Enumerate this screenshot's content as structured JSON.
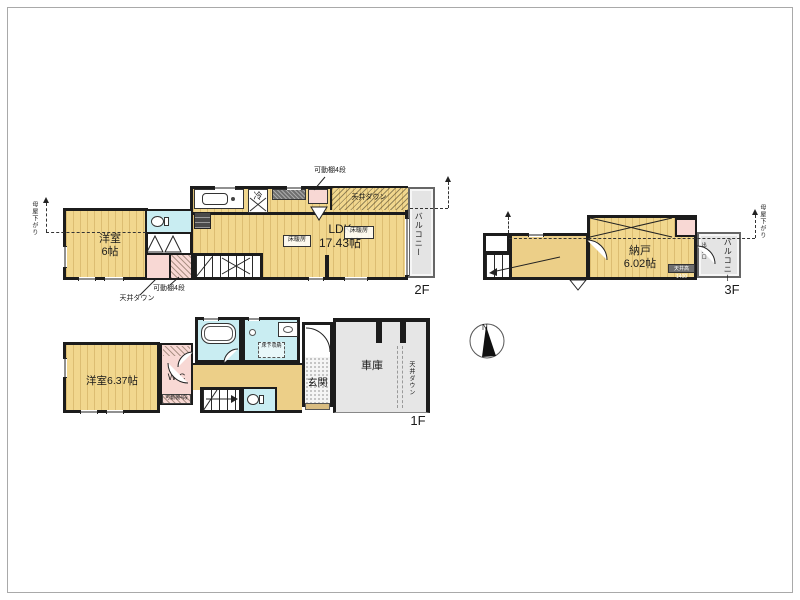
{
  "colors": {
    "floor_stripe_yellow": "#f1d78e",
    "closet_pink": "#f8d8d4",
    "wet_area_cyan": "#c9edf2",
    "garage_gray": "#e6e6e6",
    "wall_black": "#1c1c1c",
    "entry_step_tan": "#d8bc82"
  },
  "floor2": {
    "floor_label": "2F",
    "yoshitsu_name": "洋室",
    "yoshitsu_size": "6帖",
    "ldk_name": "LDK",
    "ldk_size": "17.43帖",
    "fridge": "冷",
    "floor_heating": "床暖房",
    "balcony": "バルコニー",
    "shelf_top": "可動棚4段",
    "ceiling_down_top": "天井ダウン",
    "shelf_bottom": "可動棚4段",
    "ceiling_down_bottom": "天井ダウン",
    "moya_sagari": "母屋下がり"
  },
  "floor3": {
    "floor_label": "3F",
    "nando_name": "納戸",
    "nando_size": "6.02帖",
    "balcony": "バルコニー",
    "door_label": "出入口",
    "moya_sagari": "母屋下がり",
    "low_ceiling": "天井高1400"
  },
  "floor1": {
    "floor_label": "1F",
    "yoshitsu": "洋室6.37帖",
    "wic": "WIC",
    "shelf": "可動棚4段",
    "underfloor_storage": "床下収納",
    "entrance": "玄関",
    "garage": "車庫",
    "ceiling_down": "天井ダウン"
  },
  "compass": {
    "north": "N"
  }
}
